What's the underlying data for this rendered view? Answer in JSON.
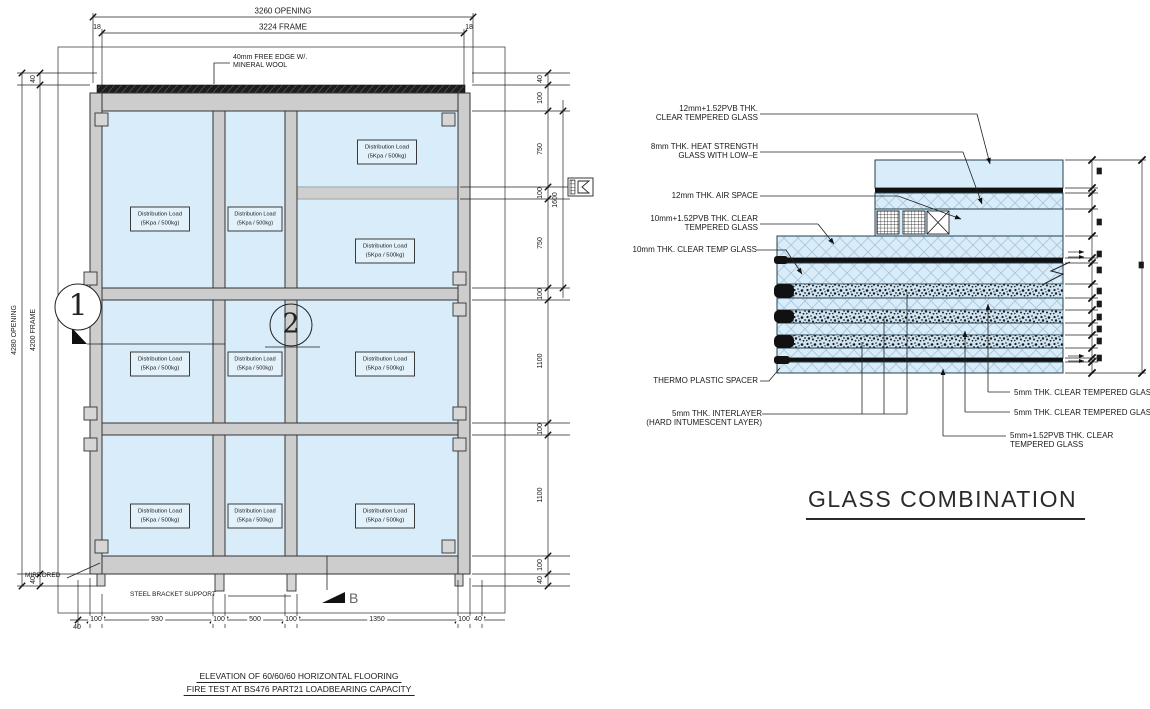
{
  "colors": {
    "glass": "#d9ecf9",
    "frame_gray": "#cdcdcd",
    "band_gray": "#cfcfcf",
    "line": "#222222",
    "wool_dark": "#1d1d1d",
    "hatch": "#a9c6da",
    "speckle_bg": "#cfe4f2"
  },
  "elevation": {
    "dim_opening_top": "3260 OPENING",
    "dim_frame_top": "3224 FRAME",
    "dim_offset_left": "18",
    "dim_offset_right": "18",
    "dim_opening_left": "4280 OPENING",
    "dim_frame_left": "4200 FRAME",
    "dim_gap_top": "40",
    "dim_gap_bottom": "40",
    "dims_right": [
      "40",
      "100",
      "750",
      "100",
      "750",
      "100",
      "1100",
      "100",
      "1100",
      "100",
      "40"
    ],
    "dim_right_outer": "1600",
    "dims_bottom": [
      "100",
      "930",
      "100",
      "500",
      "100",
      "1350",
      "100"
    ],
    "dim_bottom_left": "40",
    "dim_bottom_right": "40",
    "free_edge_line1": "40mm FREE EDGE W/.",
    "free_edge_line2": "MINERAL WOOL",
    "load_line1": "Distribution Load",
    "load_line2": "(5Kpa / 500kg)",
    "marker1": "1",
    "marker2": "2",
    "markerB": "B",
    "mirrored": "MIRRORED",
    "steel_bracket": "STEEL BRACKET SUPPORT",
    "title1": "ELEVATION OF 60/60/60 HORIZONTAL FLOORING",
    "title2": "FIRE TEST AT BS476 PART21 LOADBEARING CAPACITY"
  },
  "detail": {
    "label_12pvb_1": "12mm+1.52PVB THK.",
    "label_12pvb_2": "CLEAR TEMPERED GLASS",
    "label_8mm_1": "8mm THK. HEAT STRENGTH",
    "label_8mm_2": "GLASS WITH LOW–E",
    "label_air": "12mm THK. AIR SPACE",
    "label_10pvb_1": "10mm+1.52PVB THK. CLEAR",
    "label_10pvb_2": "TEMPERED GLASS",
    "label_10mm": "10mm THK. CLEAR TEMP GLASS",
    "label_spacer": "THERMO PLASTIC SPACER",
    "label_inter_1": "5mm THK. INTERLAYER",
    "label_inter_2": "(HARD INTUMESCENT LAYER)",
    "label_5mm_a": "5mm THK. CLEAR TEMPERED GLASS",
    "label_5mm_b": "5mm THK. CLEAR TEMPERED GLASS",
    "label_5pvb_1": "5mm+1.52PVB THK. CLEAR",
    "label_5pvb_2": "TEMPERED GLASS",
    "title": "GLASS COMBINATION"
  }
}
